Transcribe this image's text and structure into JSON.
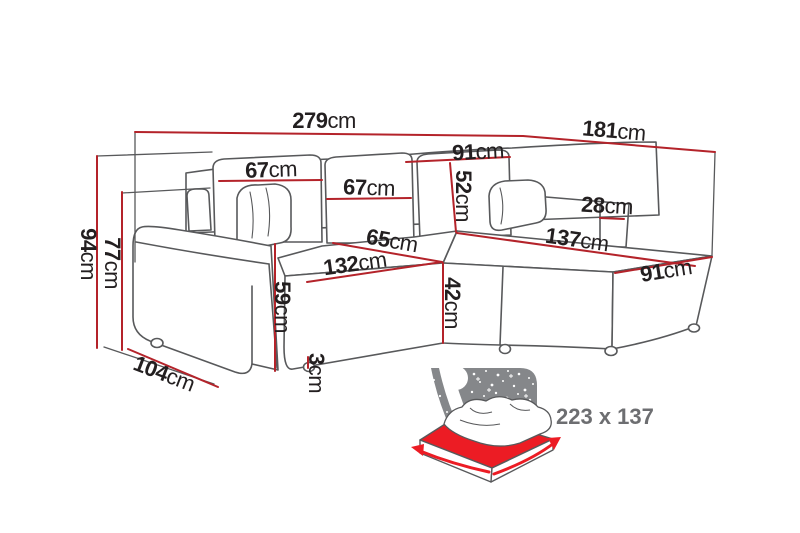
{
  "palette": {
    "dimension_red": "#b4232a",
    "outline_gray": "#58595b",
    "text_dark": "#231f20",
    "bed_red": "#ec1c24",
    "bed_gray": "#85878a",
    "bed_text_gray": "#6d6e71",
    "background": "#ffffff"
  },
  "dimensions": {
    "overall_width": {
      "value": "279",
      "unit": "cm"
    },
    "overall_depth": {
      "value": "181",
      "unit": "cm"
    },
    "overall_height": {
      "value": "94",
      "unit": "cm"
    },
    "armrest_height": {
      "value": "77",
      "unit": "cm"
    },
    "back_cushion_left": {
      "value": "67",
      "unit": "cm"
    },
    "back_cushion_middle": {
      "value": "67",
      "unit": "cm"
    },
    "back_cushion_right": {
      "value": "91",
      "unit": "cm"
    },
    "backrest_height": {
      "value": "52",
      "unit": "cm"
    },
    "right_armrest_width": {
      "value": "28",
      "unit": "cm"
    },
    "chaise_length": {
      "value": "137",
      "unit": "cm"
    },
    "seat_depth": {
      "value": "65",
      "unit": "cm"
    },
    "seat_width": {
      "value": "132",
      "unit": "cm"
    },
    "front_height": {
      "value": "59",
      "unit": "cm"
    },
    "base_depth": {
      "value": "104",
      "unit": "cm"
    },
    "seat_height": {
      "value": "42",
      "unit": "cm"
    },
    "leg_height": {
      "value": "3",
      "unit": "cm"
    },
    "chaise_width": {
      "value": "91",
      "unit": "cm"
    }
  },
  "sleeping_area": {
    "size": "223 x 137"
  }
}
